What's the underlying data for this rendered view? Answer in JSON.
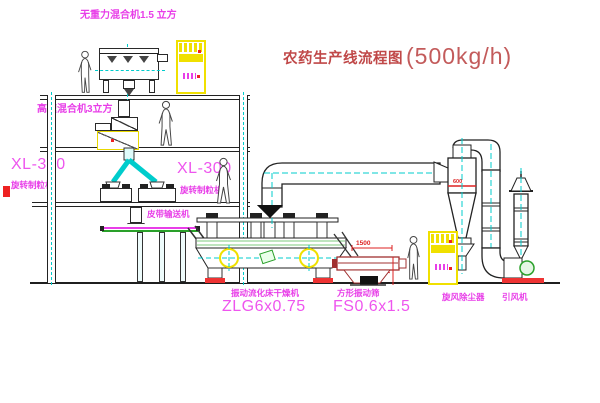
{
  "title": {
    "name": "农药生产线流程图",
    "capacity": "(500kg/h)"
  },
  "labels": {
    "gravity_mixer": "无重力混合机1.5 立方",
    "high_speed_mixer": "高速混合机3立方",
    "granulator_left_model": "XL-300",
    "granulator_left_name": "旋转制粒机",
    "granulator_right_model": "XL-300",
    "granulator_right_name": "旋转制粒机",
    "belt_conveyor": "皮带输送机",
    "fluid_bed_dryer": "振动流化床干燥机",
    "fluid_bed_dryer_model": "ZLG6x0.75",
    "square_sieve": "方形振动筛",
    "square_sieve_model": "FS0.6x1.5",
    "cyclone": "旋风除尘器",
    "induced_draft_fan": "引风机"
  },
  "dimensions": {
    "sieve_length": "1500",
    "sieve_height": "740",
    "cyclone_diameter": "600"
  },
  "colors": {
    "label_magenta": "#e83ee8",
    "title_red": "#c04848",
    "centerline_cyan": "#00cccc",
    "highlight_yellow": "#f0e000",
    "dimension_red": "#dd2222",
    "machine_green": "#2aa02a"
  }
}
